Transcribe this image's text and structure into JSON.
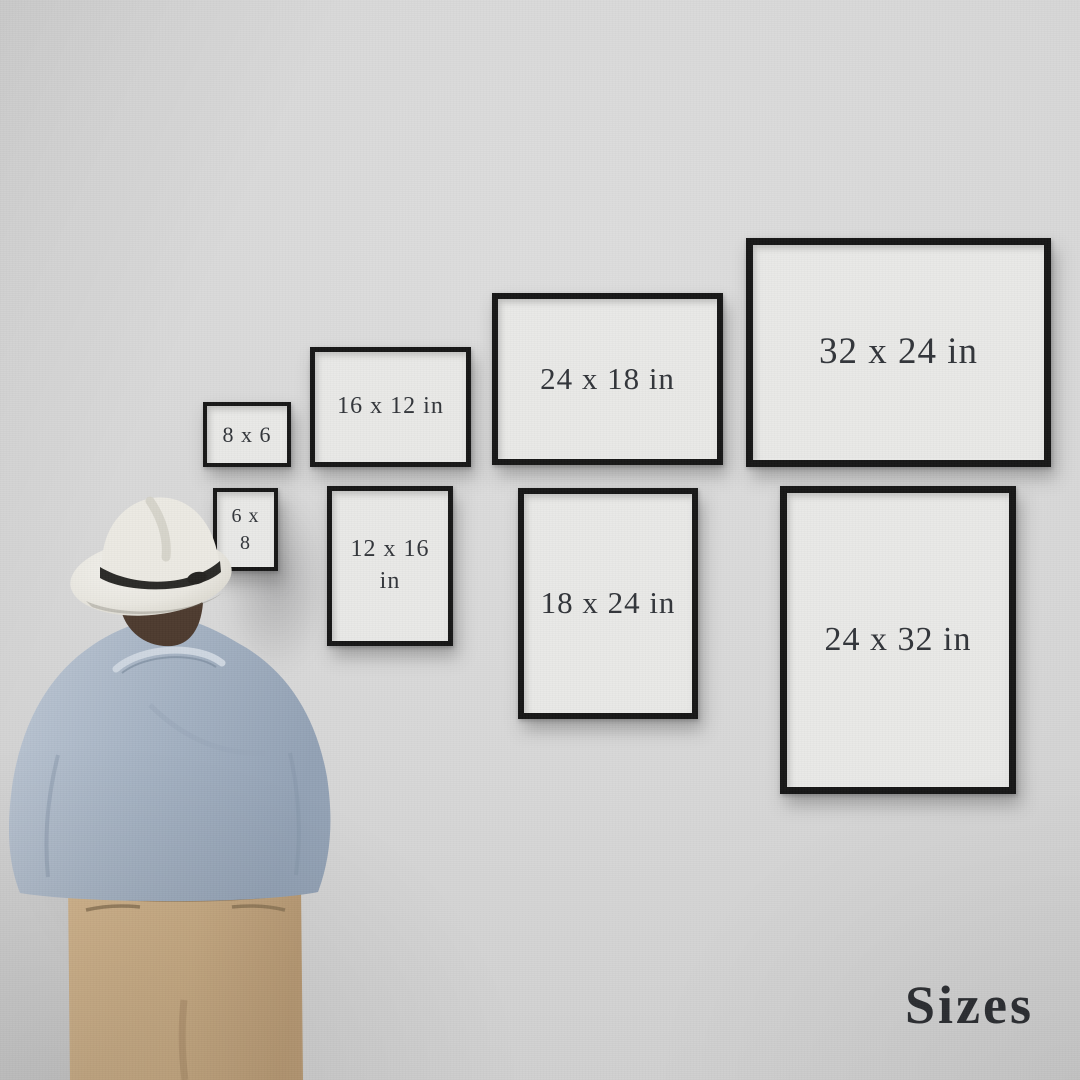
{
  "scene": {
    "title_label": "Sizes",
    "description": "Man in a fedora viewing a wall of framed print-size mockups"
  },
  "frames": [
    {
      "id": "8x6",
      "label": "8 x 6",
      "orientation": "landscape",
      "row": "top",
      "width_in": 8,
      "height_in": 6
    },
    {
      "id": "16x12",
      "label": "16 x 12 in",
      "orientation": "landscape",
      "row": "top",
      "width_in": 16,
      "height_in": 12
    },
    {
      "id": "24x18",
      "label": "24 x 18 in",
      "orientation": "landscape",
      "row": "top",
      "width_in": 24,
      "height_in": 18
    },
    {
      "id": "32x24",
      "label": "32 x 24 in",
      "orientation": "landscape",
      "row": "top",
      "width_in": 32,
      "height_in": 24
    },
    {
      "id": "6x8",
      "label": "6 x 8",
      "orientation": "portrait",
      "row": "bottom",
      "width_in": 6,
      "height_in": 8
    },
    {
      "id": "12x16",
      "label": "12 x 16 in",
      "orientation": "portrait",
      "row": "bottom",
      "width_in": 12,
      "height_in": 16
    },
    {
      "id": "18x24",
      "label": "18 x 24 in",
      "orientation": "portrait",
      "row": "bottom",
      "width_in": 18,
      "height_in": 24
    },
    {
      "id": "24x32",
      "label": "24 x 32 in",
      "orientation": "portrait",
      "row": "bottom",
      "width_in": 24,
      "height_in": 32
    }
  ],
  "colors": {
    "wall": "#d6d6d6",
    "frame_border": "#161616",
    "frame_mat": "#e9e9e7",
    "label_text": "#32353a",
    "title_text": "#2d2f33",
    "hat": "#ecebe5",
    "hat_band": "#2b2a27",
    "hair": "#4d3b2f",
    "shirt": "#a8b5c5",
    "pants": "#c9ac85"
  }
}
